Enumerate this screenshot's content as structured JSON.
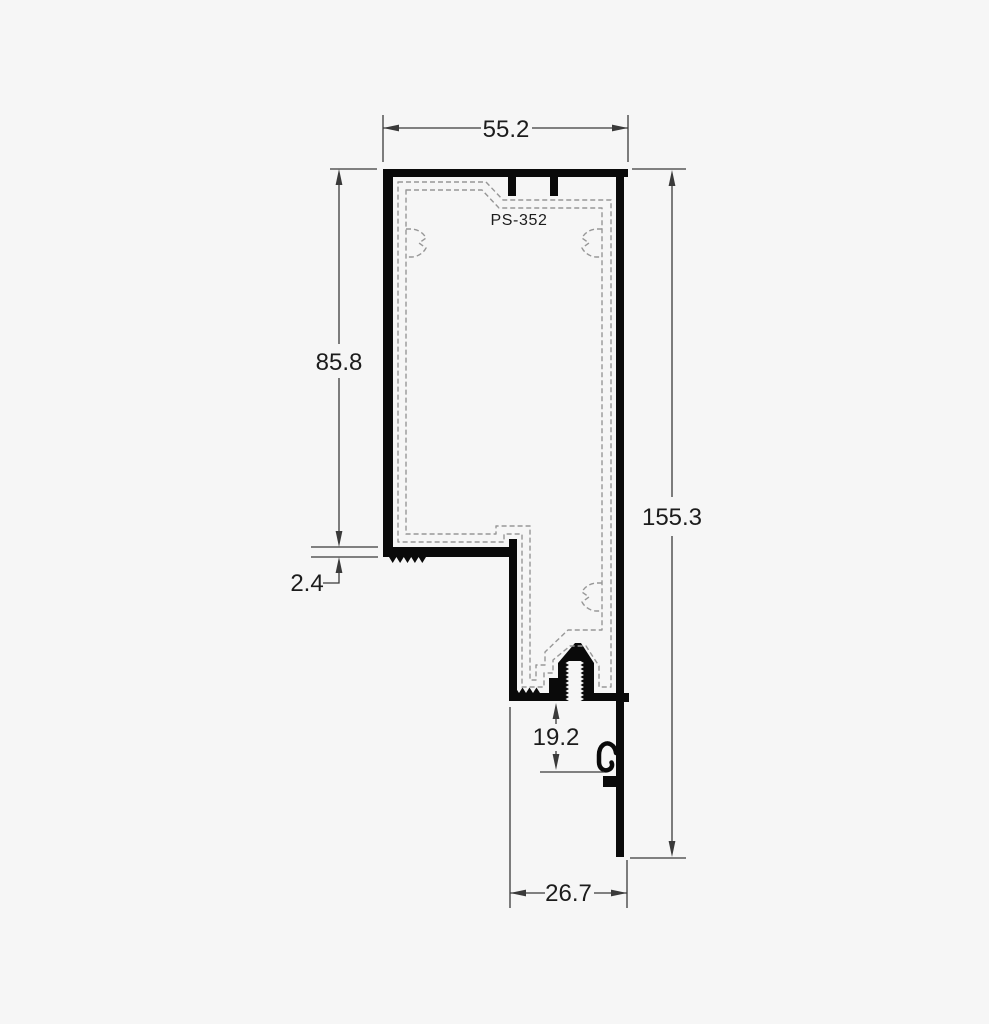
{
  "drawing": {
    "profile_label": "PS-352",
    "dimensions": {
      "top_width": "55.2",
      "upper_height": "85.8",
      "step_thickness": "2.4",
      "total_height": "155.3",
      "boss_depth": "19.2",
      "bottom_width": "26.7"
    },
    "colors": {
      "background": "#f6f6f6",
      "profile": "#0a0a0a",
      "dashed": "#979797",
      "dimension_line": "#3a3a3a",
      "text": "#1c1c1c"
    }
  }
}
